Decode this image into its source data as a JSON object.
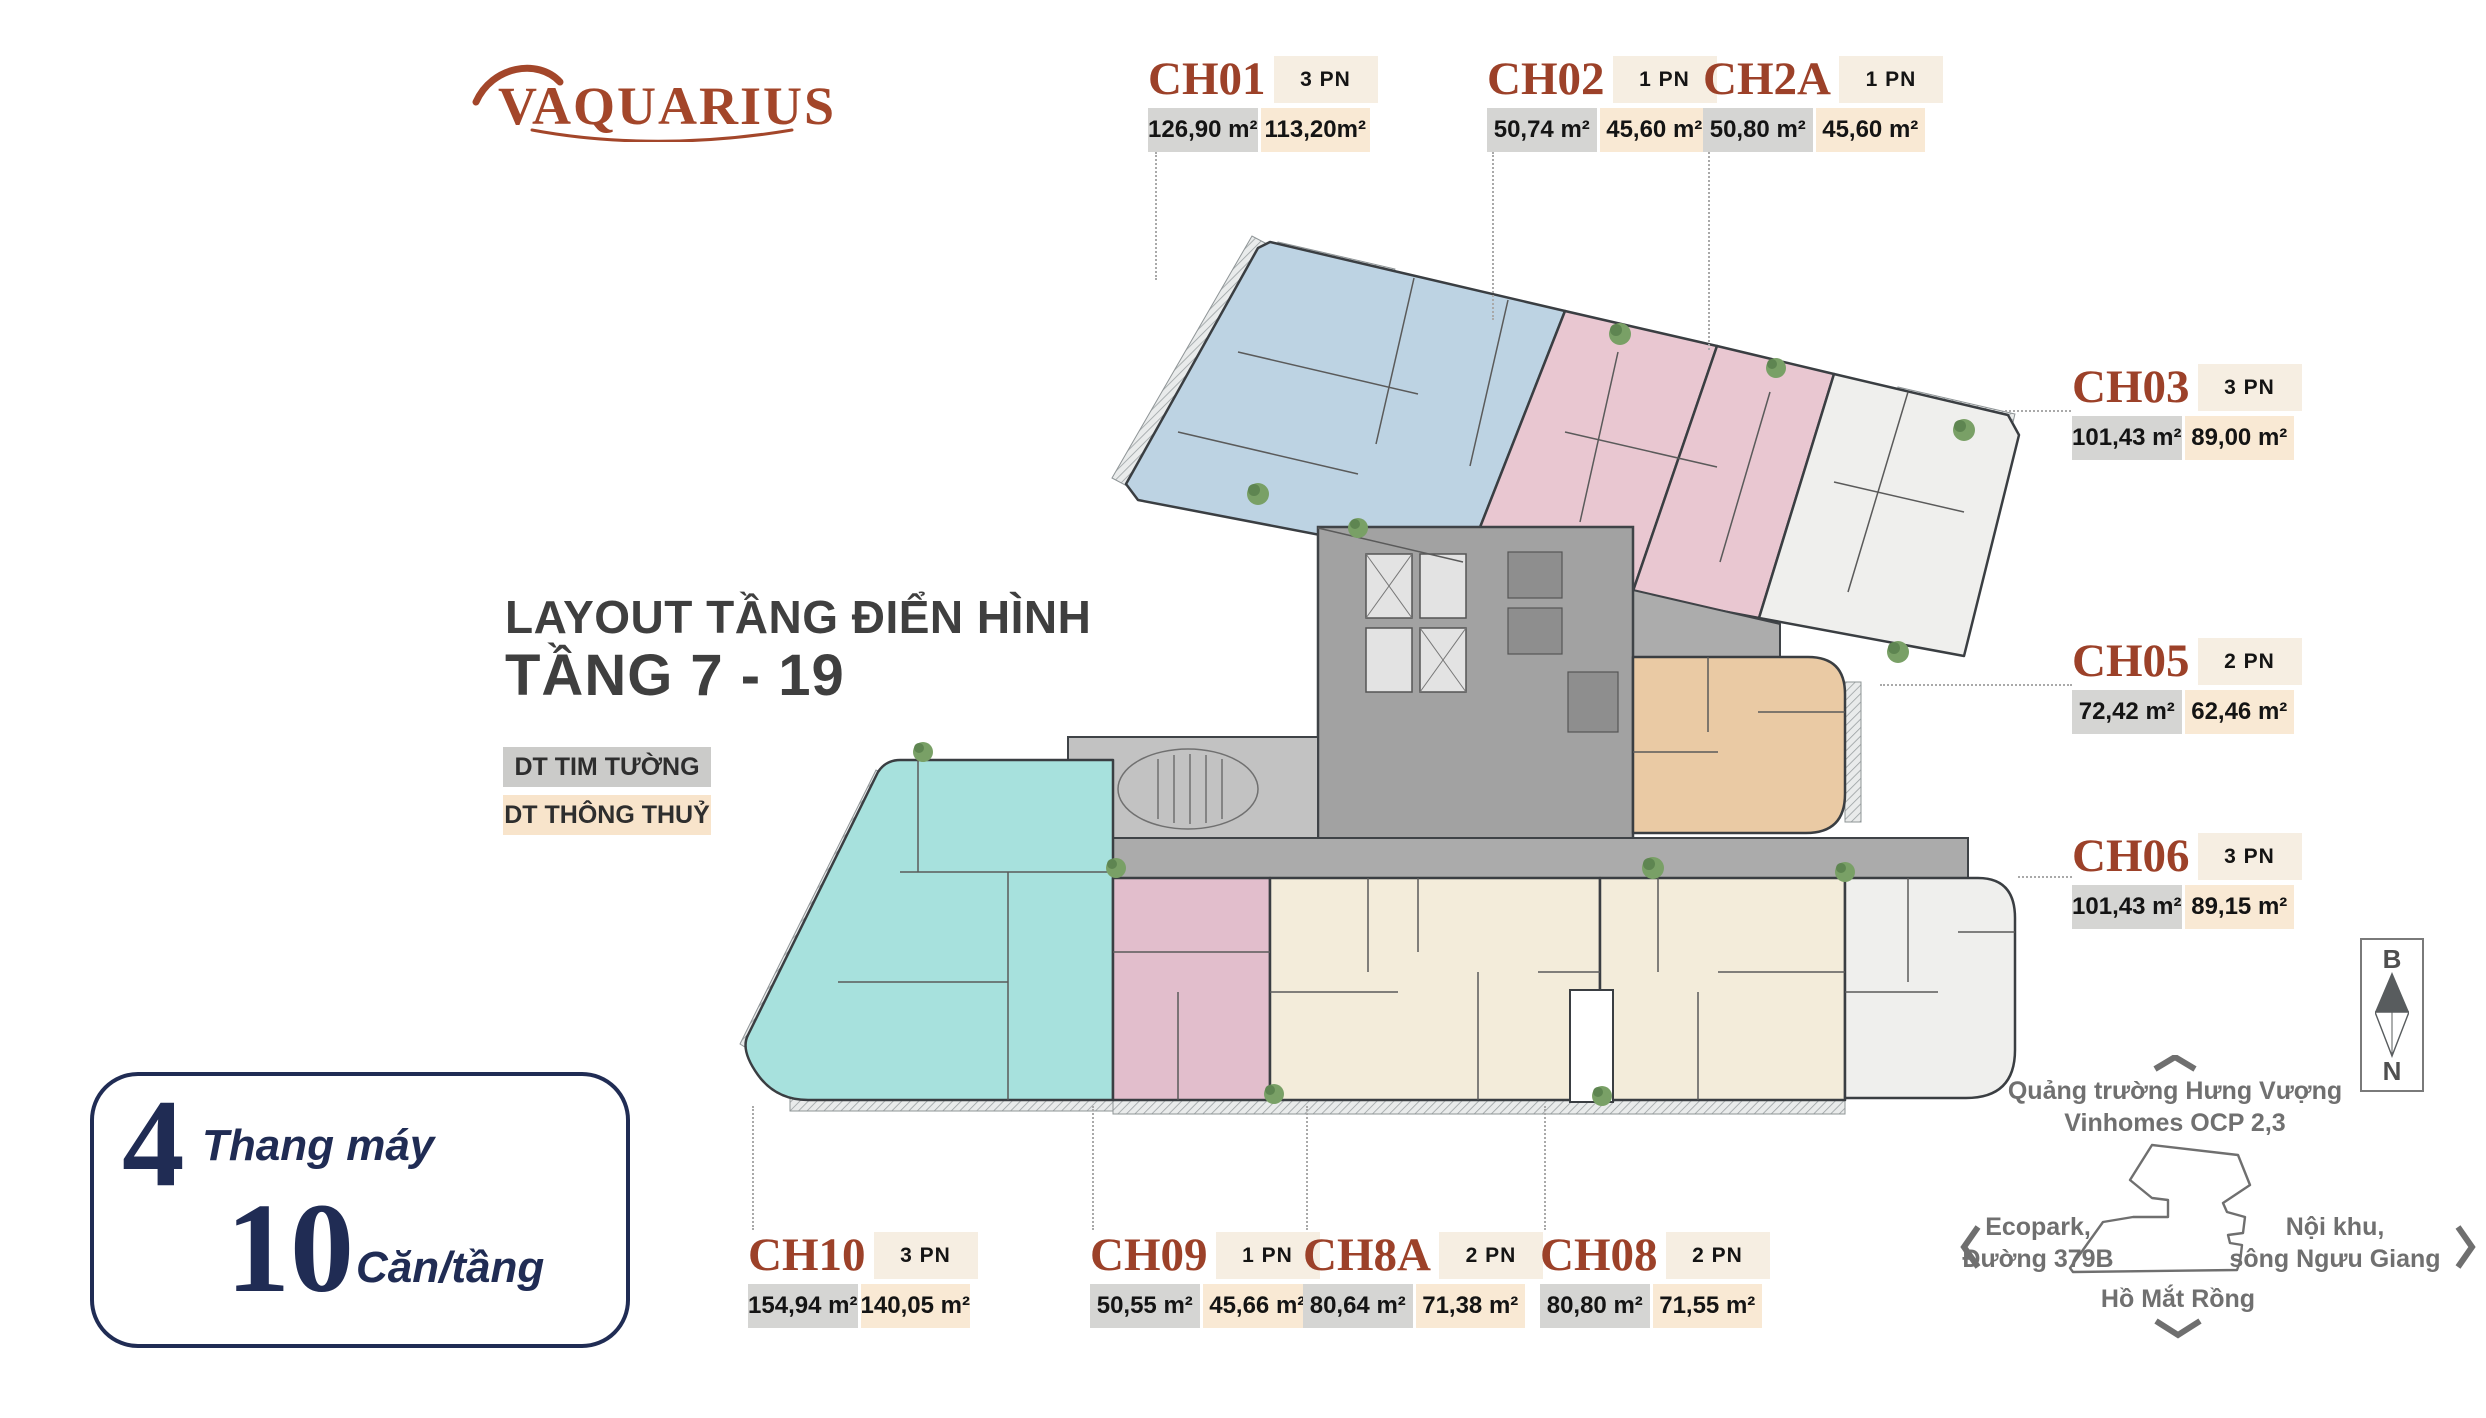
{
  "brand": {
    "name": "VAQUARIUS",
    "color": "#A3462A"
  },
  "heading": {
    "line1": "LAYOUT TẦNG ĐIỂN HÌNH",
    "line2": "TẦNG 7 - 19",
    "color": "#3F3F3F"
  },
  "legend": {
    "tim_tuong": {
      "label": "DT TIM TƯỜNG",
      "bg": "#CBCBC9"
    },
    "thong_thuy": {
      "label": "DT THÔNG THUỶ",
      "bg": "#F8E4CB"
    }
  },
  "info_box": {
    "elevators_value": "4",
    "elevators_label": "Thang máy",
    "units_value": "10",
    "units_label": "Căn/tầng",
    "color": "#202C54"
  },
  "apartments": [
    {
      "code": "CH01",
      "pn": "3 PN",
      "area1": "126,90 m²",
      "area2": "113,20m²",
      "color": "#BDD3E3"
    },
    {
      "code": "CH02",
      "pn": "1 PN",
      "area1": "50,74 m²",
      "area2": "45,60 m²",
      "color": "#E9C7D1"
    },
    {
      "code": "CH2A",
      "pn": "1 PN",
      "area1": "50,80 m²",
      "area2": "45,60 m²",
      "color": "#E9C7D1"
    },
    {
      "code": "CH03",
      "pn": "3 PN",
      "area1": "101,43 m²",
      "area2": "89,00 m²",
      "color": "#EFEFED"
    },
    {
      "code": "CH05",
      "pn": "2 PN",
      "area1": "72,42 m²",
      "area2": "62,46 m²",
      "color": "#EACAA4"
    },
    {
      "code": "CH06",
      "pn": "3 PN",
      "area1": "101,43 m²",
      "area2": "89,15 m²",
      "color": "#EFEFED"
    },
    {
      "code": "CH10",
      "pn": "3 PN",
      "area1": "154,94 m²",
      "area2": "140,05 m²",
      "color": "#A7E1DD"
    },
    {
      "code": "CH09",
      "pn": "1 PN",
      "area1": "50,55 m²",
      "area2": "45,66 m²",
      "color": "#E2BECC"
    },
    {
      "code": "CH8A",
      "pn": "2 PN",
      "area1": "80,64 m²",
      "area2": "71,38 m²",
      "color": "#F3ECDA"
    },
    {
      "code": "CH08",
      "pn": "2 PN",
      "area1": "80,80 m²",
      "area2": "71,55 m²",
      "color": "#F3ECDA"
    }
  ],
  "compass": {
    "north_label": "B",
    "south_label": "N"
  },
  "minimap": {
    "north": [
      "Quảng trường Hưng Vượng",
      "Vinhomes OCP 2,3"
    ],
    "west": [
      "Ecopark,",
      "Đường 379B"
    ],
    "east": [
      "Nội khu,",
      "sông Ngưu Giang"
    ],
    "south": "Hồ Mắt Rồng"
  }
}
